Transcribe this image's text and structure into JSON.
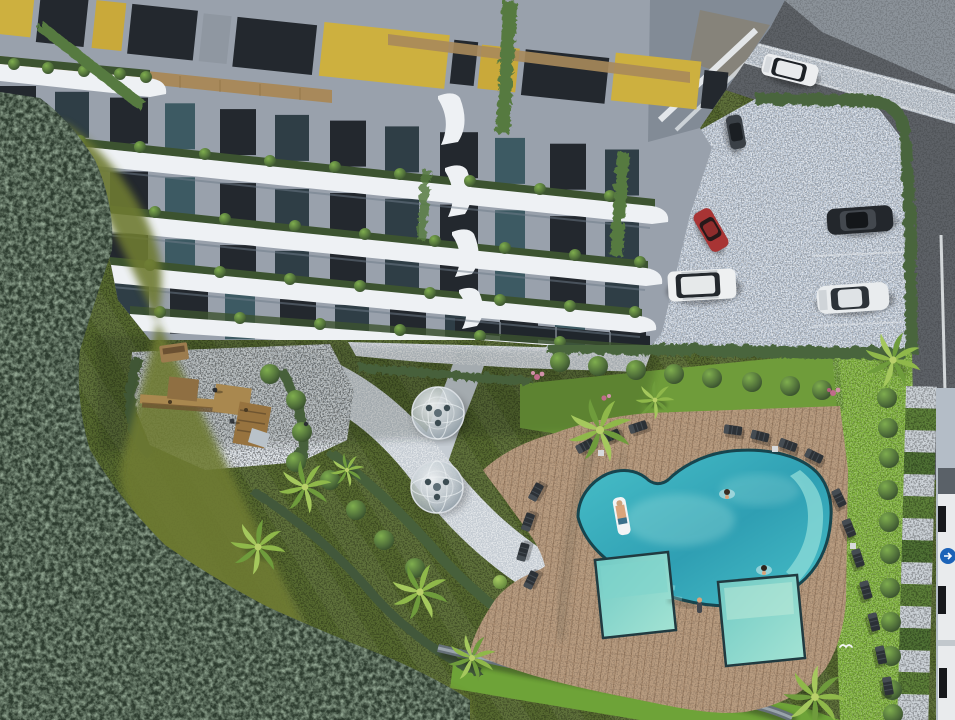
{
  "scene": {
    "kind": "aerial-3d-architectural-render",
    "subject": "modern residential apartment complex with landscaped amenity garden, swimming pool and parking lot",
    "view": "top-down bird's-eye perspective"
  },
  "palette": {
    "water_deep": "#2f9fb3",
    "water_mid": "#49c0c9",
    "water_light": "#93e2da",
    "kids_pool_light": "#a5e4d4",
    "kids_pool_deep": "#6fc9c4",
    "deck_wood": "#b79b7f",
    "lawn_bright": "#7fb13c",
    "lawn_garden": "#55682f",
    "forest": "#2c3b2e",
    "hedge": "#49653c",
    "pebble": "#cbd1d8",
    "parking": "#b9c4d2",
    "asphalt": "#5d6166",
    "asphalt_light": "#8b9299",
    "sidewalk": "#b4bdc7",
    "balcony_white": "#eef1f4",
    "facade": "#99a1ac",
    "window_dark": "#23282e",
    "window_teal": "#3d5a63",
    "accent_yellow": "#cdb03f",
    "wood": "#a8895b",
    "car_red": "#a83434",
    "car_black": "#23272c",
    "car_white": "#eceef0",
    "truck_logo": "#1c63b8",
    "skin": "#d9a47b"
  },
  "building": {
    "balcony_planters": "green shrubs along every balcony edge",
    "facade_features": "gray facade, dark glazing, mustard-yellow window panels, wood strips, vertical planted vines"
  },
  "amenities": {
    "main_pool": {
      "shape": "organic kidney",
      "swimmers": 2,
      "float_riders": 1
    },
    "kids_pools": 2,
    "dome_gazebos": 2,
    "playground": "wooden climbing structure on pebble plaza",
    "sun_loungers": 18,
    "palm_trees": 9,
    "deck": "wooden plank pool deck"
  },
  "vehicles": {
    "parked": [
      {
        "type": "car",
        "color": "red"
      },
      {
        "type": "car",
        "color": "dark-gray"
      },
      {
        "type": "sedan",
        "color": "black"
      },
      {
        "type": "sedan",
        "color": "white"
      },
      {
        "type": "suv",
        "color": "white"
      }
    ],
    "moving": [
      {
        "type": "suv",
        "color": "white",
        "location": "road top-right"
      }
    ],
    "truck": {
      "color": "white",
      "location": "right edge",
      "logo": "blue circle"
    }
  },
  "landscape": {
    "forest": "dense dark trees along left and bottom-left",
    "hedges": "sculpted hedge walls enclosing parking and walkways",
    "right_lawn": "bright lawn with row of clipped hedge balls and checkerboard planting walkway",
    "bird": "white seagull flying over the deck",
    "person_on_deck": 1
  }
}
